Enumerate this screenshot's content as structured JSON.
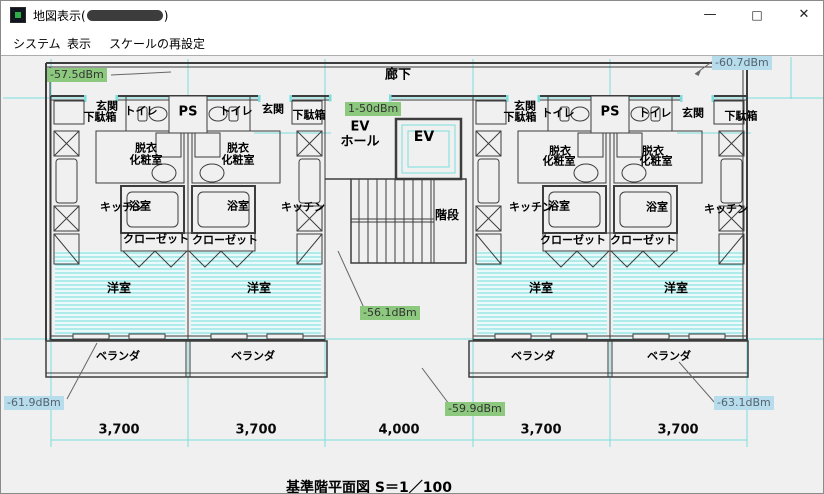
{
  "window": {
    "title_prefix": "地図表示(",
    "title_suffix": ")",
    "icons": {
      "minimize": "—",
      "maximize": "□",
      "close": "✕"
    }
  },
  "menu": {
    "items": [
      {
        "label": "システム"
      },
      {
        "label": "表示"
      },
      {
        "label": "スケールの再設定"
      }
    ]
  },
  "plan": {
    "sheet_title": "基準階平面図  S＝1／100",
    "corridor": "廊下",
    "ps_label": "PS",
    "core": {
      "ev_hall_line1": "EV",
      "ev_hall_line2": "ホール",
      "elevator": "EV",
      "stairs": "階段"
    },
    "units": [
      {
        "genkan": "玄関",
        "getabako": "下駄箱",
        "toilet": "トイレ",
        "datsui": "脱衣",
        "kesho": "化粧室",
        "kitchen": "キッチン",
        "bath": "浴室",
        "closet": "クローゼット",
        "yoshitsu": "洋室",
        "veranda": "ベランダ"
      },
      {
        "genkan": "玄関",
        "getabako": "下駄箱",
        "toilet": "トイレ",
        "datsui": "脱衣",
        "kesho": "化粧室",
        "kitchen": "キッチン",
        "bath": "浴室",
        "closet": "クローゼット",
        "yoshitsu": "洋室",
        "veranda": "ベランダ"
      },
      {
        "genkan": "玄関",
        "getabako": "下駄箱",
        "toilet": "トイレ",
        "datsui": "脱衣",
        "kesho": "化粧室",
        "kitchen": "キッチン",
        "bath": "浴室",
        "closet": "クローゼット",
        "yoshitsu": "洋室",
        "veranda": "ベランダ"
      },
      {
        "genkan": "玄関",
        "getabako": "下駄箱",
        "toilet": "トイレ",
        "datsui": "脱衣",
        "kesho": "化粧室",
        "kitchen": "キッチン",
        "bath": "浴室",
        "closet": "クローゼット",
        "yoshitsu": "洋室",
        "veranda": "ベランダ"
      }
    ],
    "dimensions": [
      "3,700",
      "3,700",
      "4,000",
      "3,700",
      "3,700"
    ]
  },
  "measurements": [
    {
      "text": "-57.5dBm",
      "style": "green"
    },
    {
      "text": "1-50dBm",
      "style": "green"
    },
    {
      "text": "-60.7dBm",
      "style": "blue"
    },
    {
      "text": "-56.1dBm",
      "style": "green"
    },
    {
      "text": "-59.9dBm",
      "style": "green"
    },
    {
      "text": "-61.9dBm",
      "style": "blue"
    },
    {
      "text": "-63.1dBm",
      "style": "blue"
    }
  ],
  "colors": {
    "canvas_bg": "#f0f0f0",
    "wall": "#3d3d3d",
    "construction_cyan": "#7adede",
    "measurement_green": "#8cc97e",
    "measurement_blue": "#b7dcec"
  }
}
